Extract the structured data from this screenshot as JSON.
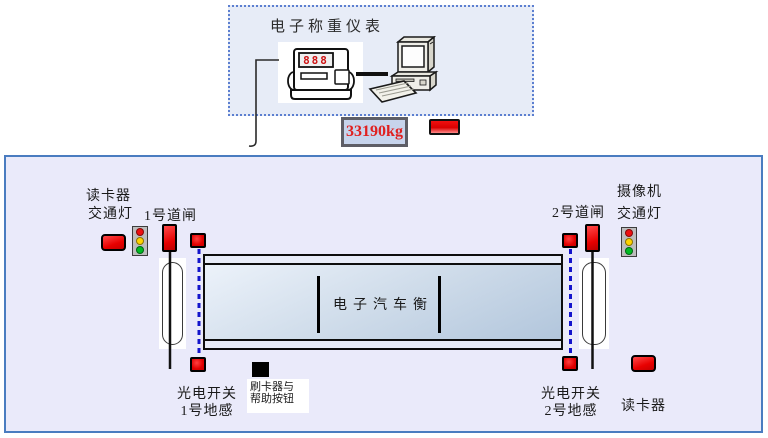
{
  "top_panel": {
    "title": "电子称重仪表",
    "indicator_digits": "888"
  },
  "weight_display": {
    "value": "33190kg"
  },
  "yard": {
    "left": {
      "reader_label": "读卡器",
      "light_label": "交通灯",
      "gate_label": "1号道闸",
      "photoswitch_line1": "光电开关",
      "photoswitch_line2": "1号地感"
    },
    "right": {
      "camera_label": "摄像机",
      "light_label": "交通灯",
      "gate_label": "2号道闸",
      "photoswitch_line1": "光电开关",
      "photoswitch_line2": "2号地感",
      "reader_label": "读卡器"
    },
    "scale_label": "电子汽车衡",
    "swiper_line1": "刷卡器与",
    "swiper_line2": "帮助按钮"
  },
  "colors": {
    "indicator_red": "#e60000",
    "traffic_red": "#ee1111",
    "traffic_yellow": "#ffd400",
    "traffic_green": "#00bb22",
    "dash_blue": "#1414cc",
    "frame_blue": "#4a7cc0",
    "weight_text_red": "#e02020"
  }
}
